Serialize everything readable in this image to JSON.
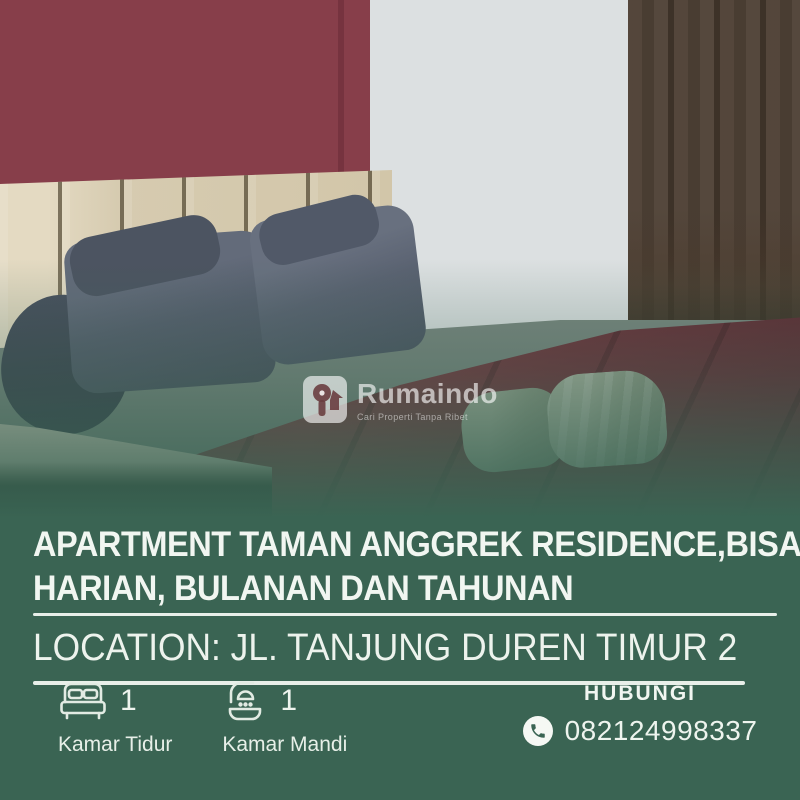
{
  "listing": {
    "title_line1": "APARTMENT TAMAN ANGGREK RESIDENCE,BISA",
    "title_line2": "HARIAN, BULANAN DAN TAHUNAN",
    "location": "LOCATION: JL. TANJUNG DUREN TIMUR 2"
  },
  "watermark": {
    "brand": "Rumaindo",
    "tagline": "Cari Properti Tanpa Ribet",
    "logo_icon": "rumaindo-key-house-icon"
  },
  "features": [
    {
      "icon": "bed-icon",
      "count": "1",
      "label": "Kamar Tidur"
    },
    {
      "icon": "bath-icon",
      "count": "1",
      "label": "Kamar Mandi"
    }
  ],
  "contact": {
    "heading": "HUBUNGI",
    "phone": "082124998337",
    "icon": "phone-icon"
  },
  "colors": {
    "panel_green": "#3a6453",
    "text_white": "#eef4ee",
    "maroon_wall": "#873e4a",
    "duvet_maroon": "#7d3941",
    "curtain_taupe": "#8d8176",
    "headboard_wood": "#d6cbb0"
  }
}
